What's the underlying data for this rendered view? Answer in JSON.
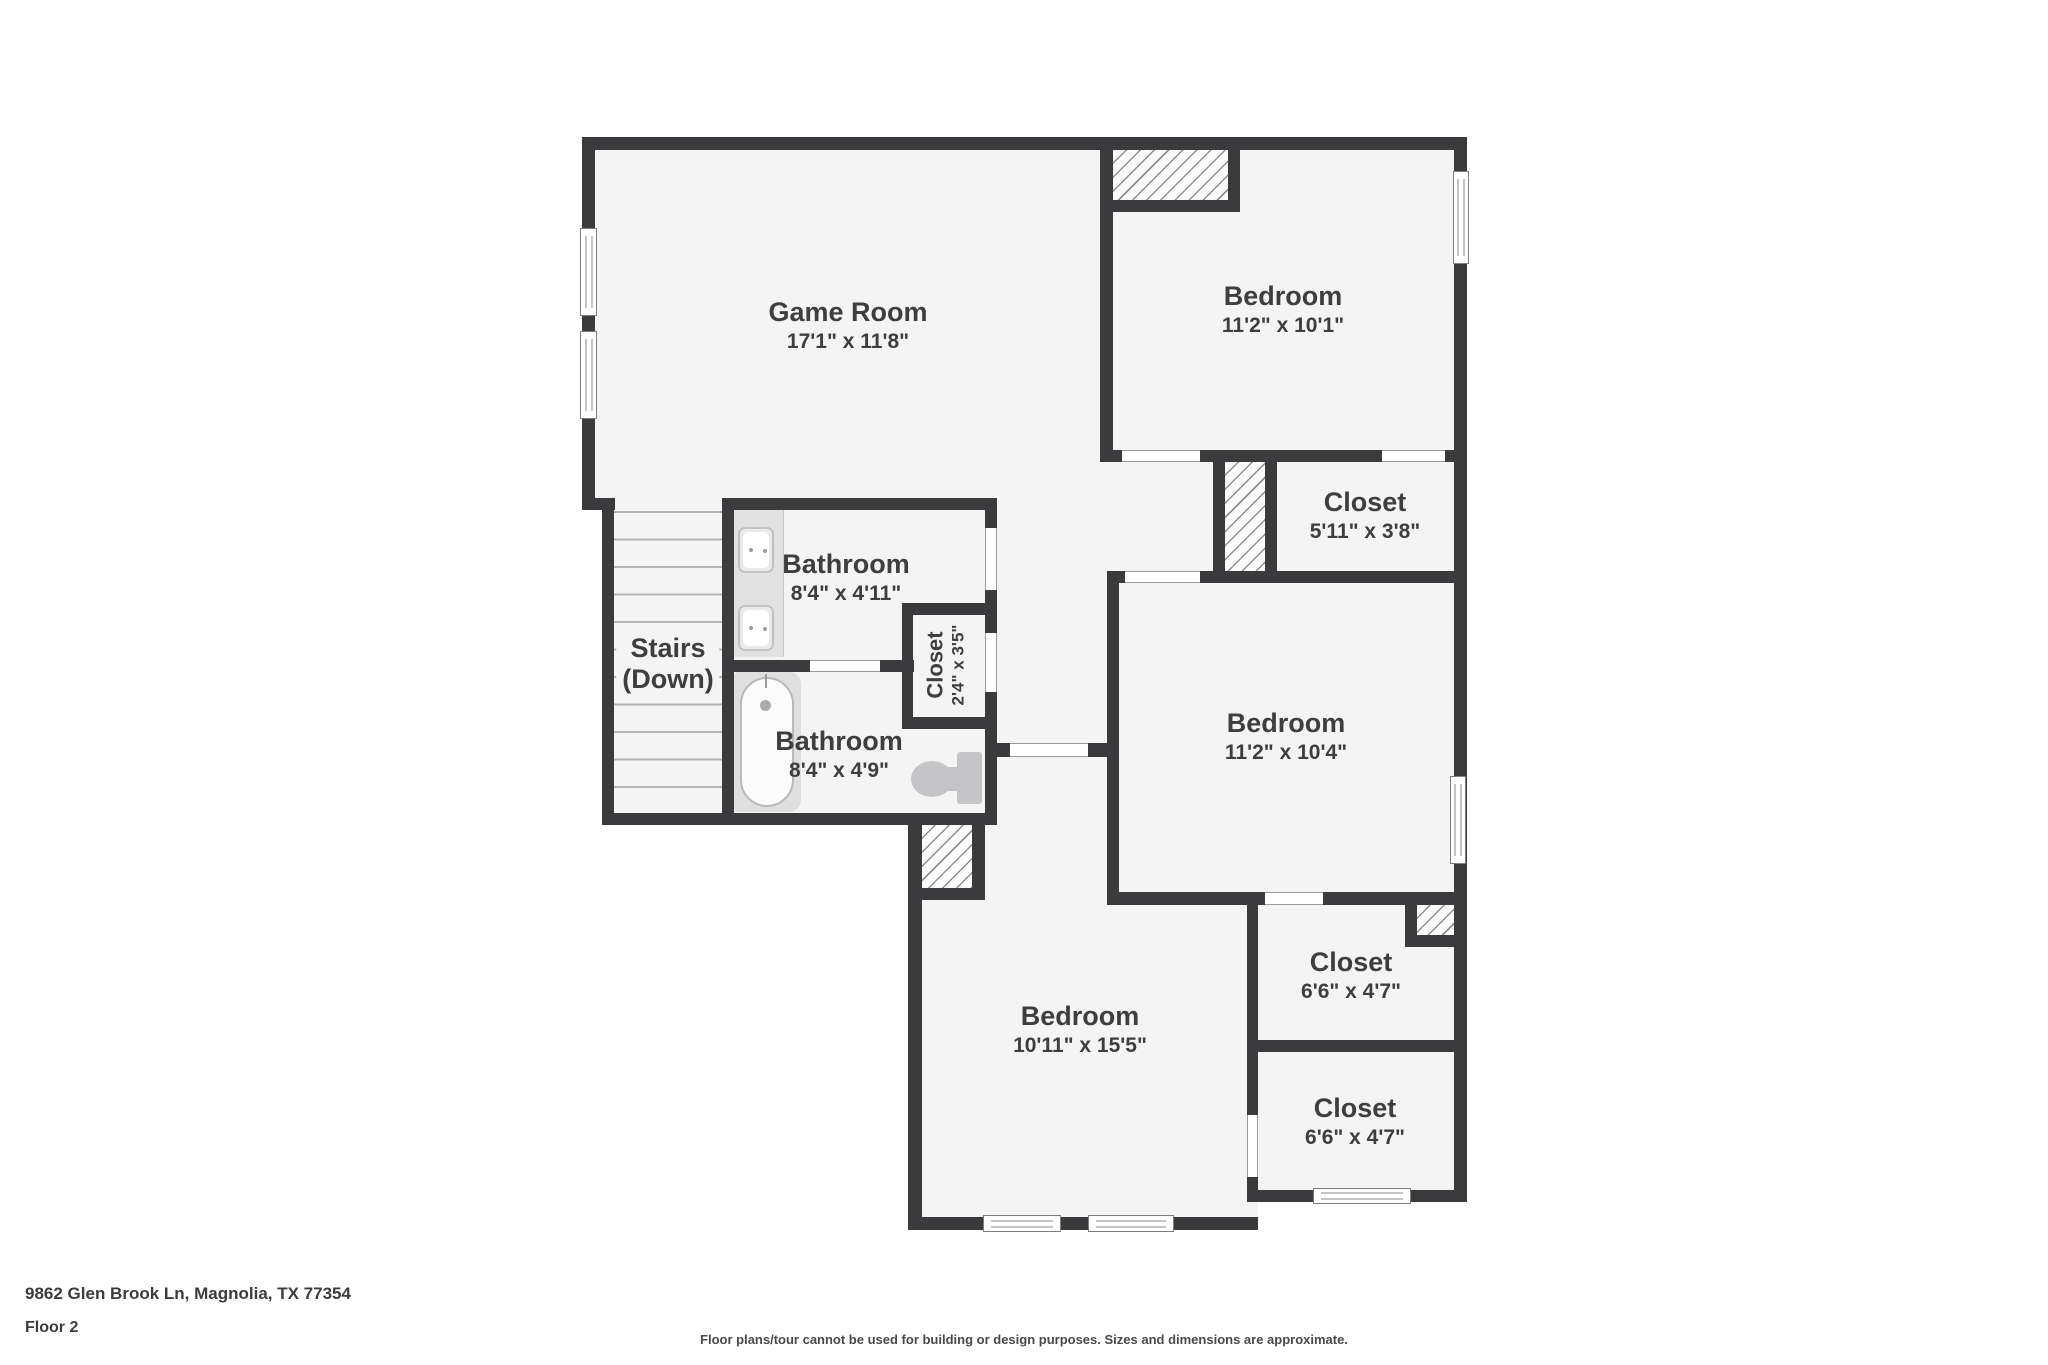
{
  "colors": {
    "wall": "#3b3b3d",
    "room_fill": "#f4f4f5",
    "hatch_line": "#8f8f8f",
    "fixture": "#c5c5c7",
    "text": "#3e3e40"
  },
  "rooms": {
    "game_room": {
      "name": "Game Room",
      "dims": "17'1\" x 11'8\""
    },
    "bedroom_top": {
      "name": "Bedroom",
      "dims": "11'2\" x 10'1\""
    },
    "closet_top": {
      "name": "Closet",
      "dims": "5'11\" x 3'8\""
    },
    "bathroom_upper": {
      "name": "Bathroom",
      "dims": "8'4\" x 4'11\""
    },
    "closet_hall": {
      "name": "Closet",
      "dims": "2'4\" x 3'5\""
    },
    "stairs": {
      "name": "Stairs",
      "dims": "(Down)"
    },
    "bathroom_lower": {
      "name": "Bathroom",
      "dims": "8'4\" x 4'9\""
    },
    "bedroom_middle": {
      "name": "Bedroom",
      "dims": "11'2\" x 10'4\""
    },
    "bedroom_bottom": {
      "name": "Bedroom",
      "dims": "10'11\" x 15'5\""
    },
    "closet_right_upper": {
      "name": "Closet",
      "dims": "6'6\" x 4'7\""
    },
    "closet_right_lower": {
      "name": "Closet",
      "dims": "6'6\" x 4'7\""
    }
  },
  "footer": {
    "address": "9862 Glen Brook Ln, Magnolia, TX 77354",
    "floor": "Floor 2",
    "disclaimer": "Floor plans/tour cannot be used for building or design purposes. Sizes and dimensions are approximate."
  }
}
